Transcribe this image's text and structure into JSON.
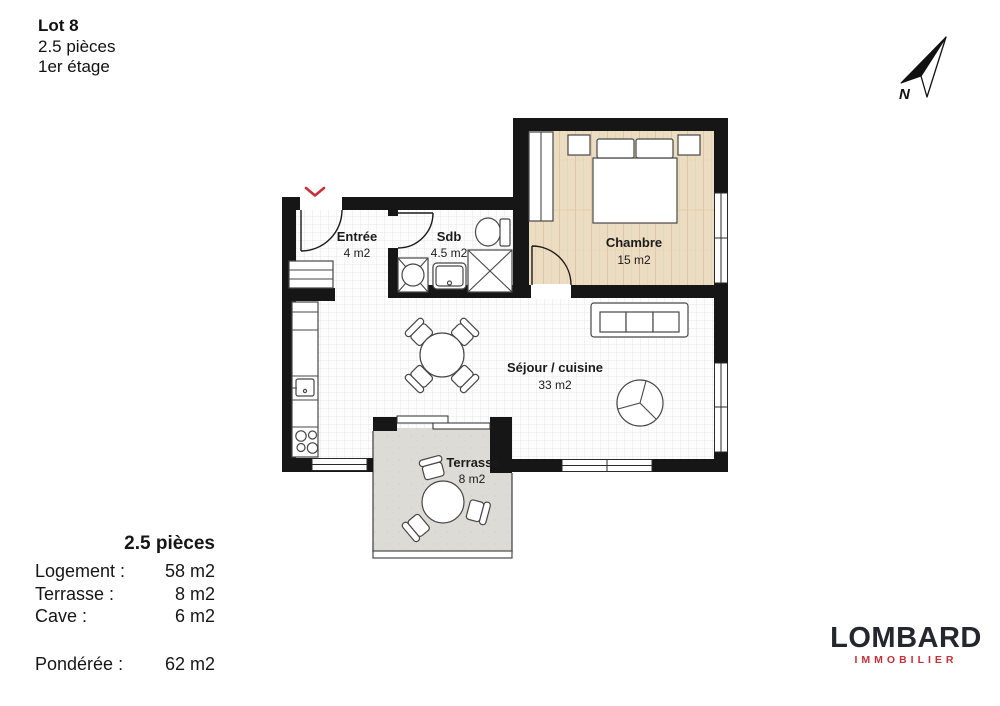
{
  "header": {
    "lot": "Lot 8",
    "type": "2.5 pièces",
    "floor": "1er étage"
  },
  "compass": {
    "label": "N",
    "icon": "compass-needle-pointing-northeast"
  },
  "floorplan": {
    "rooms": {
      "entree": {
        "name": "Entrée",
        "area": "4 m2"
      },
      "sdb": {
        "name": "Sdb",
        "area": "4.5 m2"
      },
      "chambre": {
        "name": "Chambre",
        "area": "15 m2"
      },
      "sejour": {
        "name": "Séjour / cuisine",
        "area": "33 m2"
      },
      "terrasse": {
        "name": "Terrasse",
        "area": "8 m2"
      }
    },
    "icons": {
      "entrance_marker": "chevron-down",
      "fixtures": [
        "washing-machine",
        "bathroom-sink",
        "shower",
        "toilet",
        "kitchen-counter",
        "stove-burners",
        "kitchen-sink",
        "entry-closet",
        "wardrobe",
        "double-bed",
        "nightstand",
        "sofa",
        "round-armchair",
        "dining-table",
        "dining-chair",
        "terrace-table",
        "terrace-chair"
      ]
    },
    "colors": {
      "wall": "#161616",
      "wood_floor": "#ecdcc1",
      "terrace_floor": "#dcdbd6",
      "tile_line": "#e7e7e7",
      "entrance_marker_red": "#c5303a",
      "furniture_stroke": "#474747"
    }
  },
  "legend": {
    "title": "2.5 pièces",
    "rows": [
      {
        "label": "Logement :",
        "value": "58 m2"
      },
      {
        "label": "Terrasse :",
        "value": "8 m2"
      },
      {
        "label": "Cave :",
        "value": "6 m2"
      }
    ],
    "weighted": {
      "label": "Pondérée :",
      "value": "62 m2"
    }
  },
  "logo": {
    "name": "LOMBARD",
    "tagline": "IMMOBILIER",
    "color_primary": "#26262e",
    "color_accent": "#c5303a"
  }
}
